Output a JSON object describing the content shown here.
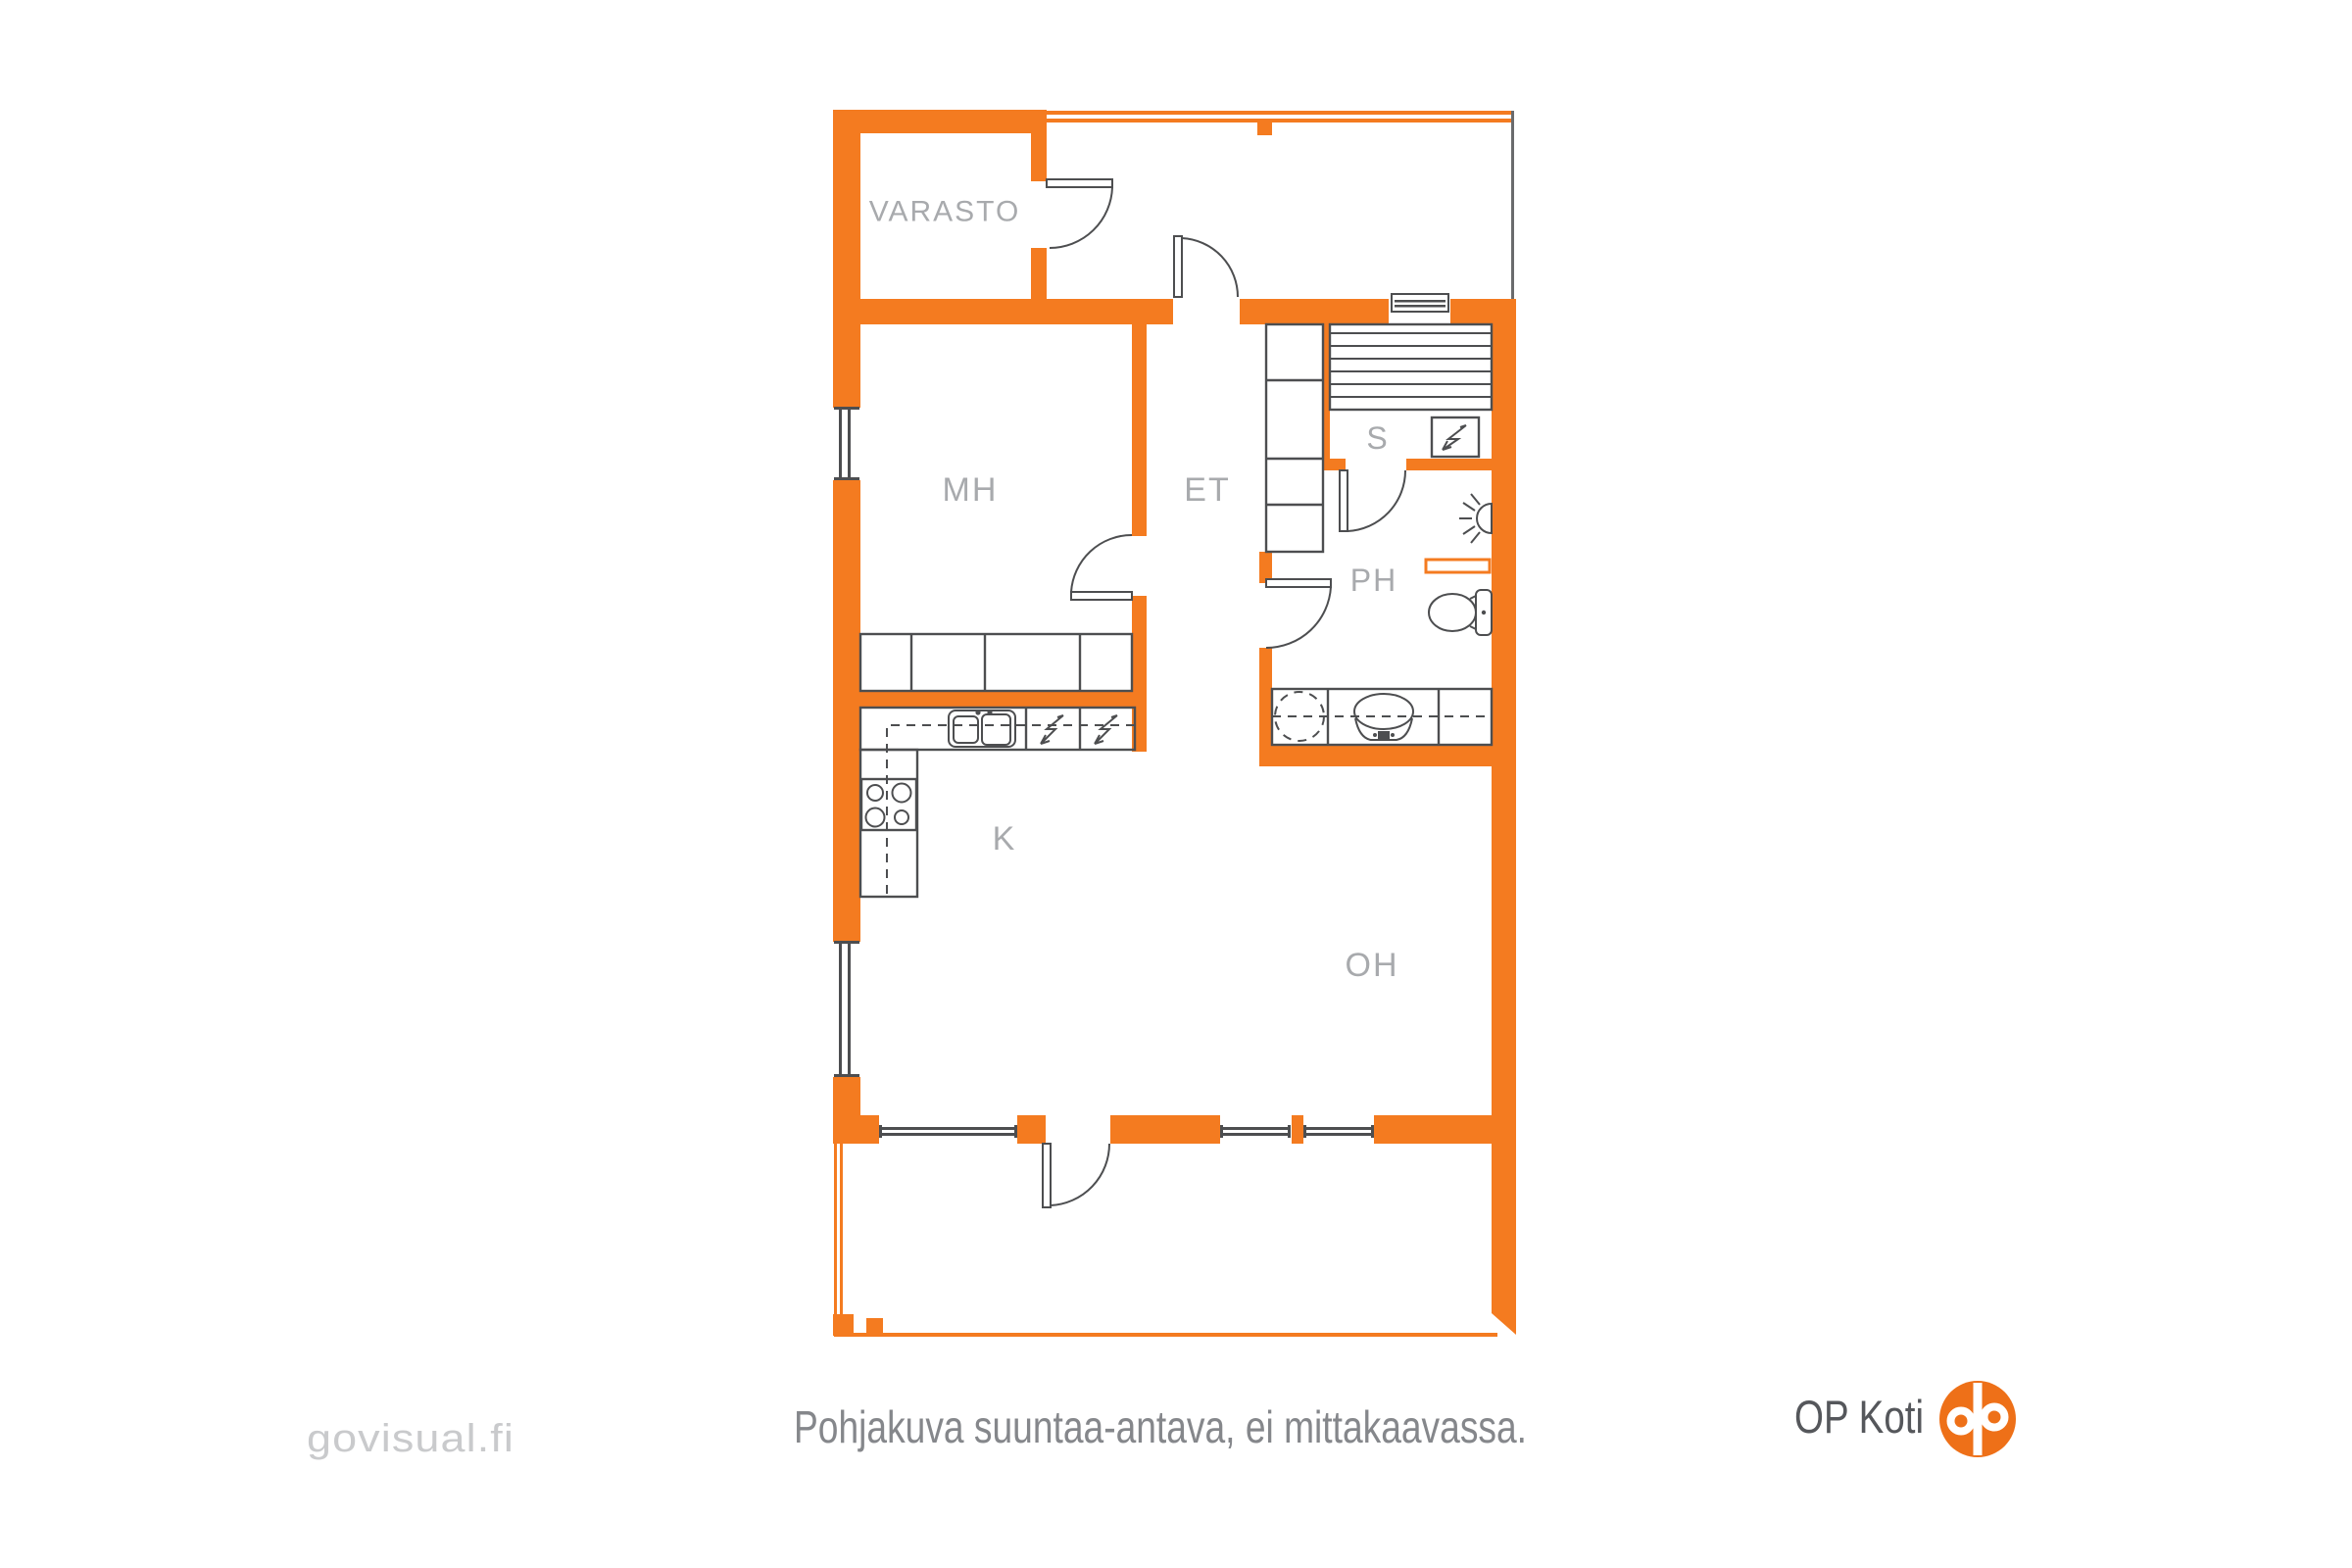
{
  "plan": {
    "room_labels": {
      "varasto": "VARASTO",
      "mh": "MH",
      "et": "ET",
      "s": "S",
      "ph": "PH",
      "k": "K",
      "oh": "OH"
    },
    "colors": {
      "wall_orange": "#f47b20",
      "fixture_gray": "#4d4e50",
      "label_gray": "#a8aaad"
    },
    "icons": [
      "door-arc",
      "window",
      "wardrobe",
      "sauna-benches",
      "sauna-stove-lightning",
      "kitchen-sink",
      "stove-burners",
      "appliance-lightning",
      "washing-machine-dashed",
      "washbasin",
      "toilet",
      "shower-head",
      "towel-rail"
    ]
  },
  "footer": {
    "caption": "Pohjakuva suuntaa-antava, ei mittakaavassa.",
    "watermark": "govisual.fi",
    "brand": {
      "text": "OP Koti",
      "logo_color": "#ee7018",
      "text_color": "#55575b"
    }
  }
}
